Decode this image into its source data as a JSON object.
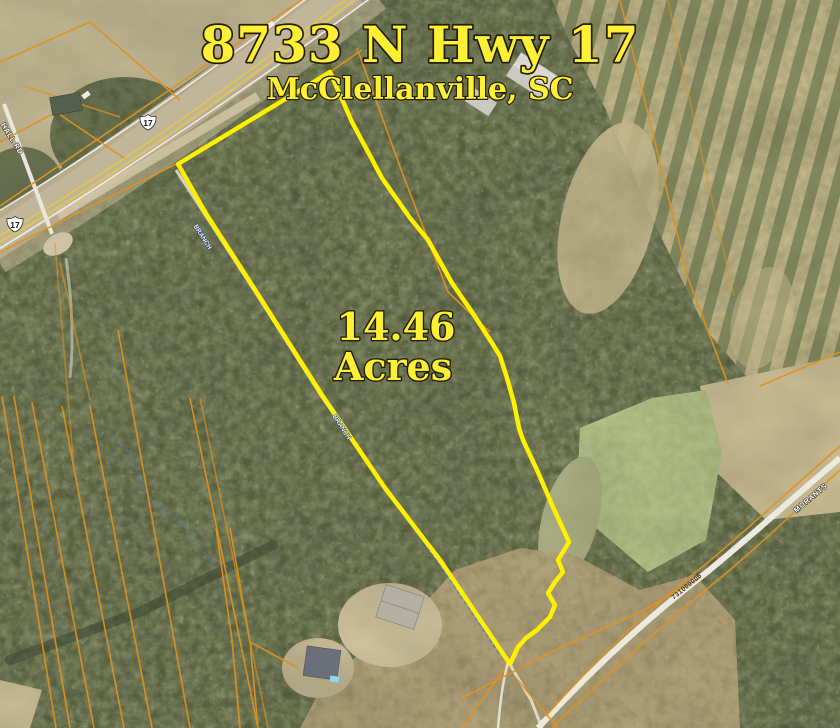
{
  "map": {
    "title": "8733 N Hwy 17",
    "subtitle": "McClellanville, SC",
    "acreage": {
      "value": "14.46",
      "unit": "Acres",
      "combined": "14.46 Acres"
    },
    "highway_shield": "17",
    "road_labels": {
      "hall_road": "HALL RD",
      "morants": "MORANTS",
      "stream": "BRANCH"
    },
    "parcel_number": "731000006",
    "colors": {
      "boundary_yellow": "#fff000",
      "title_yellow": "#ffef35",
      "parcel_line_orange": "#e0921f",
      "creek_blue": "#4e7cb8",
      "forest_green": "#636c4c",
      "marsh_tan": "#b2a37b"
    }
  }
}
